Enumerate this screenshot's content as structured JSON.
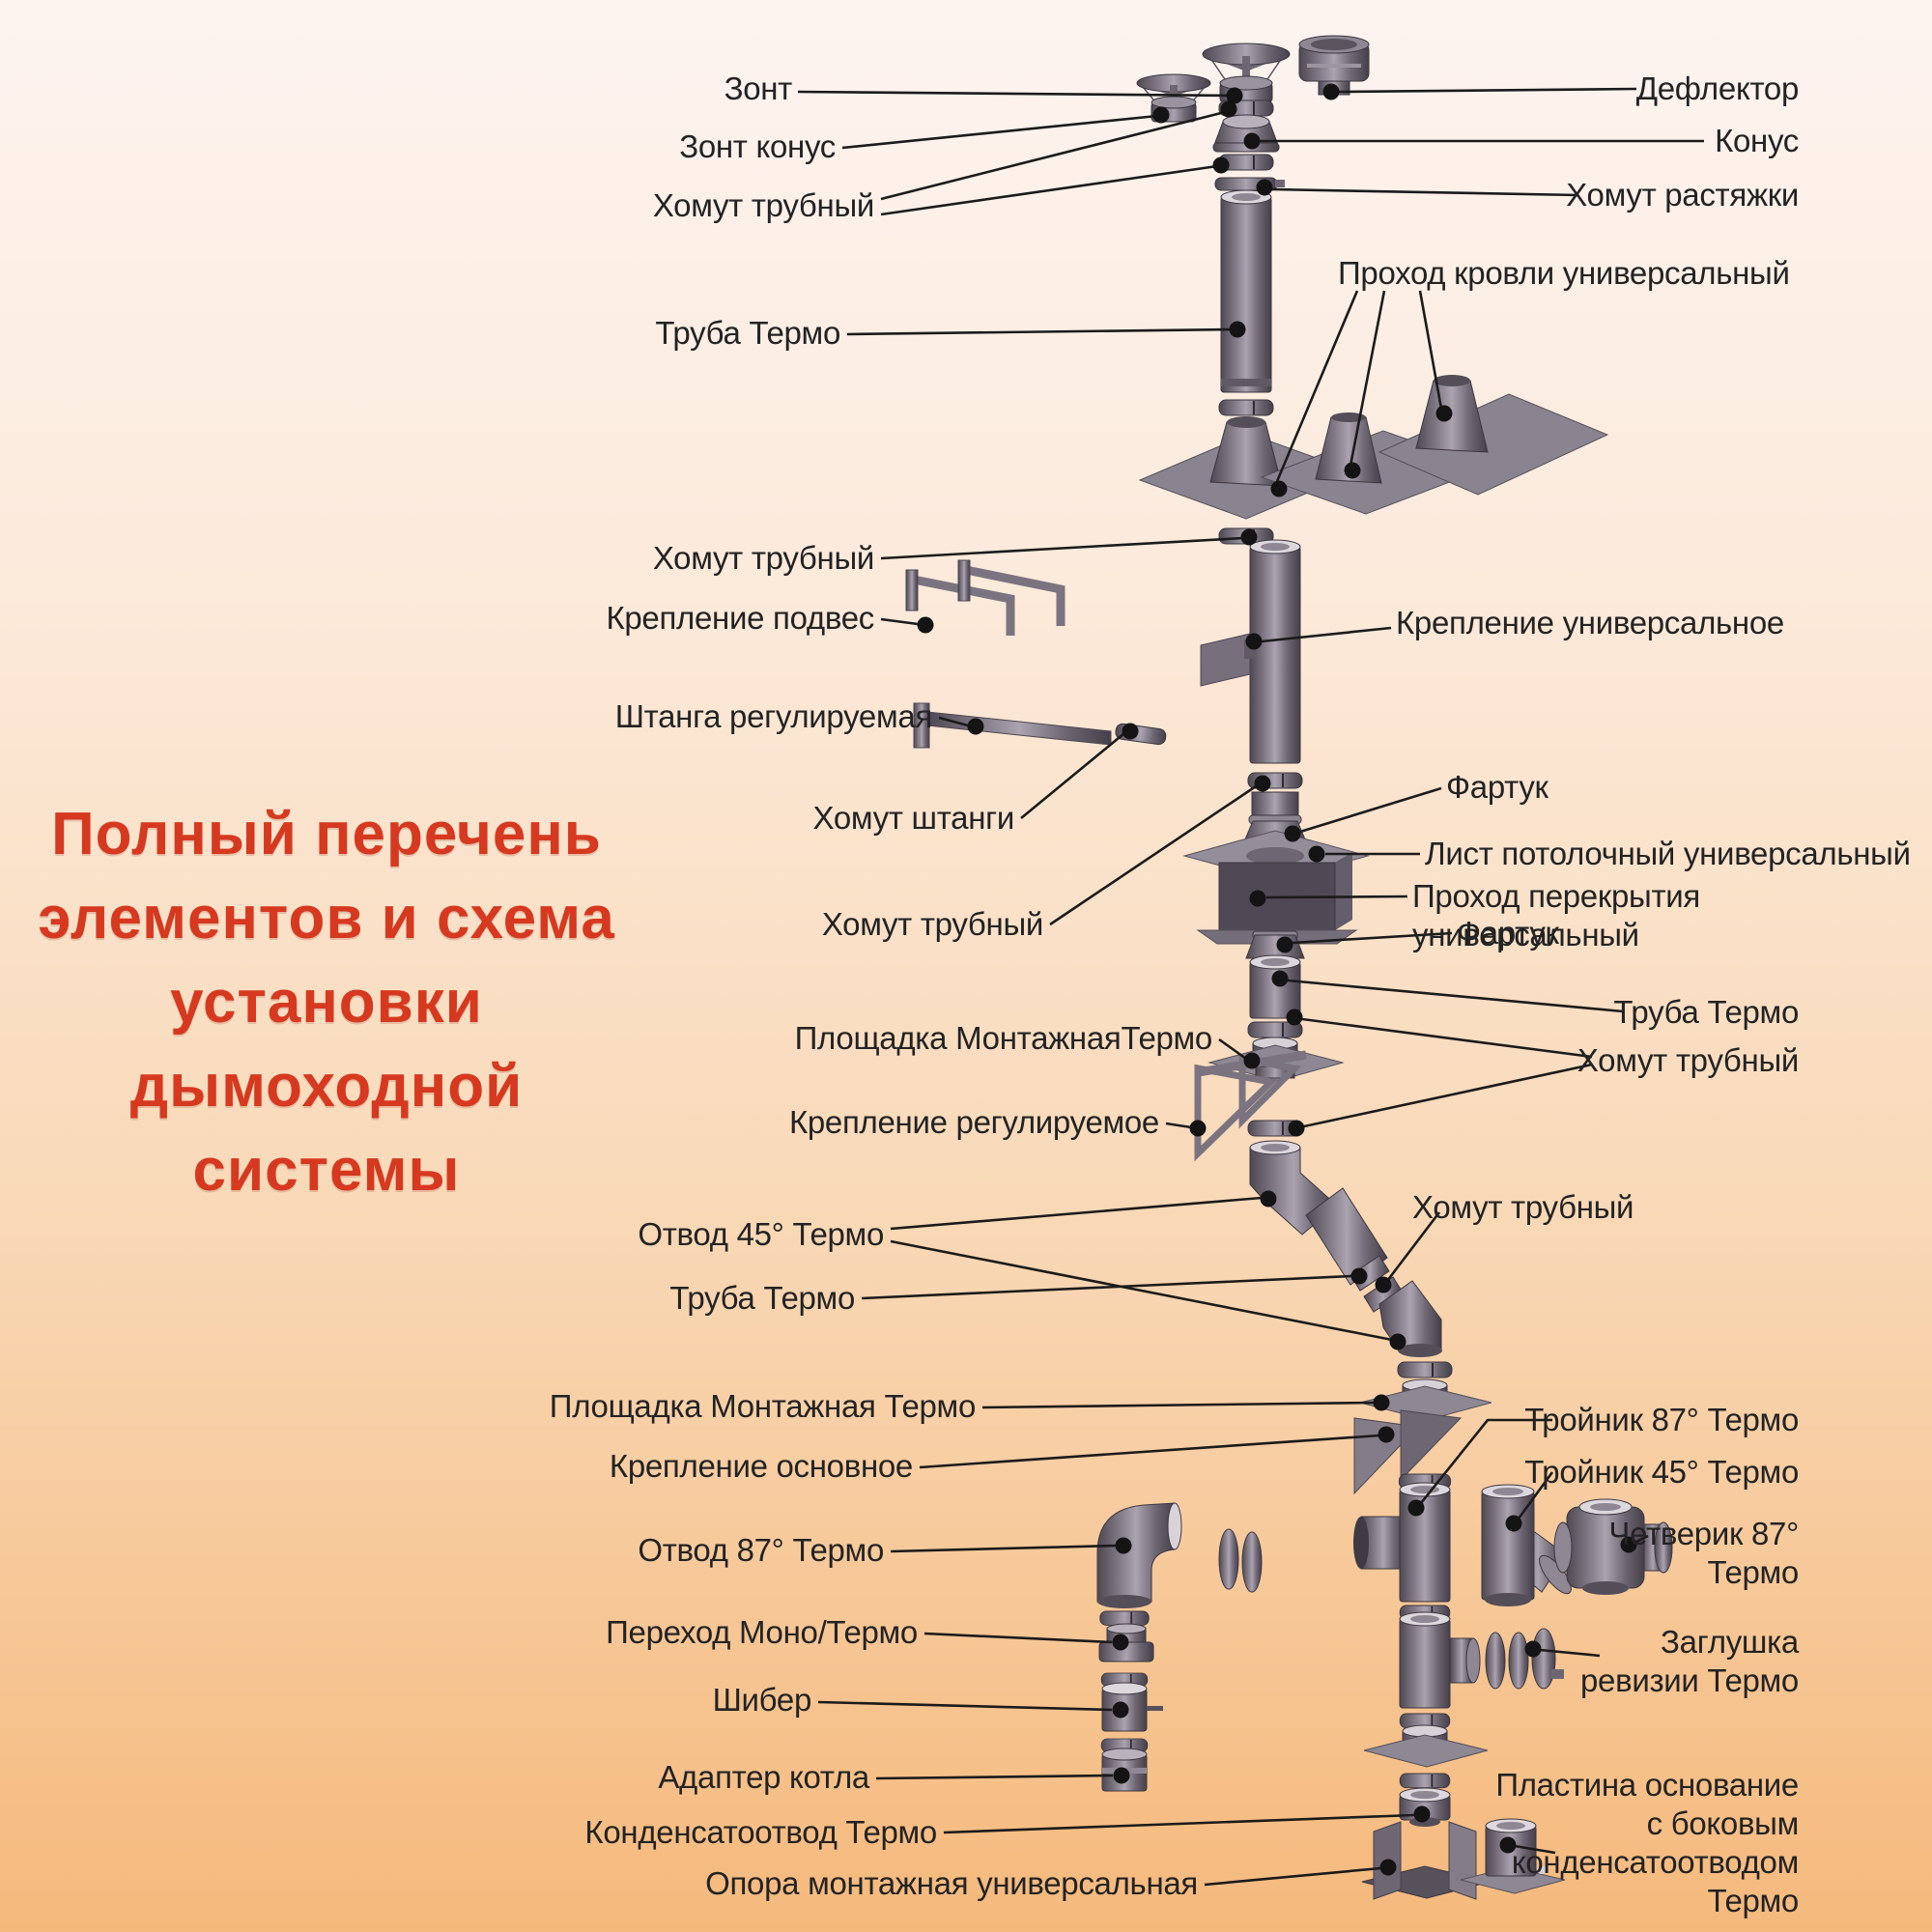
{
  "title": {
    "text": "Полный перечень\nэлементов и схема\nустановки\nдымоходной\nсистемы",
    "color": "#d6391f"
  },
  "labels": {
    "left": [
      {
        "text": "Зонт"
      },
      {
        "text": "Зонт конус"
      },
      {
        "text": "Хомут трубный"
      },
      {
        "text": "Труба Термо"
      },
      {
        "text": "Хомут трубный"
      },
      {
        "text": "Крепление подвес"
      },
      {
        "text": "Штанга регулируемая"
      },
      {
        "text": "Хомут штанги"
      },
      {
        "text": "Хомут трубный"
      },
      {
        "text": "Площадка МонтажнаяТермо"
      },
      {
        "text": "Крепление регулируемое"
      },
      {
        "text": "Отвод 45° Термо"
      },
      {
        "text": "Труба Термо"
      },
      {
        "text": "Площадка Монтажная Термо"
      },
      {
        "text": "Крепление основное"
      },
      {
        "text": "Отвод 87° Термо"
      },
      {
        "text": "Переход Моно/Термо"
      },
      {
        "text": "Шибер"
      },
      {
        "text": "Адаптер котла"
      },
      {
        "text": "Конденсатоотвод Термо"
      },
      {
        "text": "Опора монтажная универсальная"
      }
    ],
    "right": [
      {
        "text": "Дефлектор"
      },
      {
        "text": "Конус"
      },
      {
        "text": "Хомут растяжки"
      },
      {
        "text": "Проход кровли универсальный"
      },
      {
        "text": "Крепление универсальное"
      },
      {
        "text": "Фартук"
      },
      {
        "text": "Лист потолочный универсальный"
      },
      {
        "text": "Проход перекрытия универсальный"
      },
      {
        "text": "Фартук"
      },
      {
        "text": "Труба Термо"
      },
      {
        "text": "Хомут трубный"
      },
      {
        "text": "Хомут трубный"
      },
      {
        "text": "Тройник 87° Термо"
      },
      {
        "text": "Тройник 45° Термо"
      },
      {
        "text": "Четверик 87°\nТермо"
      },
      {
        "text": "Заглушка\nревизии Термо"
      },
      {
        "text": "Пластина основание\nс боковым\nконденсатоотводом\nТермо"
      }
    ]
  },
  "colors": {
    "background_top": "#fdf4f0",
    "background_bottom": "#f5b97c",
    "title_red": "#d6391f",
    "label_text": "#232323",
    "metal_mid": "#847d89",
    "leader_line": "#1b1b1b"
  }
}
